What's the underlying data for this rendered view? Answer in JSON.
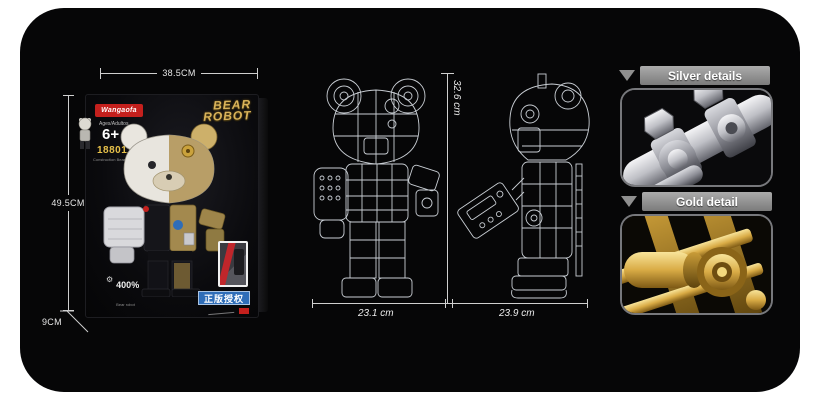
{
  "panel": {
    "background": "#060607"
  },
  "box": {
    "brand": "Wangaofa",
    "ages_label": "Ages/Adultos",
    "age_badge": "6+",
    "item_number": "188011",
    "item_caption": "Construction Bear robot",
    "title_line1": "BEAR",
    "title_line2": "ROBOT",
    "scale_label": "400%",
    "scale_caption": "Bear robot",
    "license_banner": "正版授权",
    "dim_width": "38.5CM",
    "dim_height": "49.5CM",
    "dim_depth": "9CM"
  },
  "blueprints": {
    "height_label": "32.6 cm",
    "front_width_label": "23.1 cm",
    "side_width_label": "23.9 cm"
  },
  "details": {
    "silver_label": "Silver details",
    "gold_label": "Gold detail"
  },
  "colors": {
    "dimension_line": "#cfcfcf",
    "brand_red": "#c4201d",
    "item_number_gold": "#e7c14a",
    "banner_blue": "#2f6db8",
    "detail_header_gray": "#8f8f8f",
    "silver": "#c6c7cc",
    "gold": "#d9ab45"
  }
}
